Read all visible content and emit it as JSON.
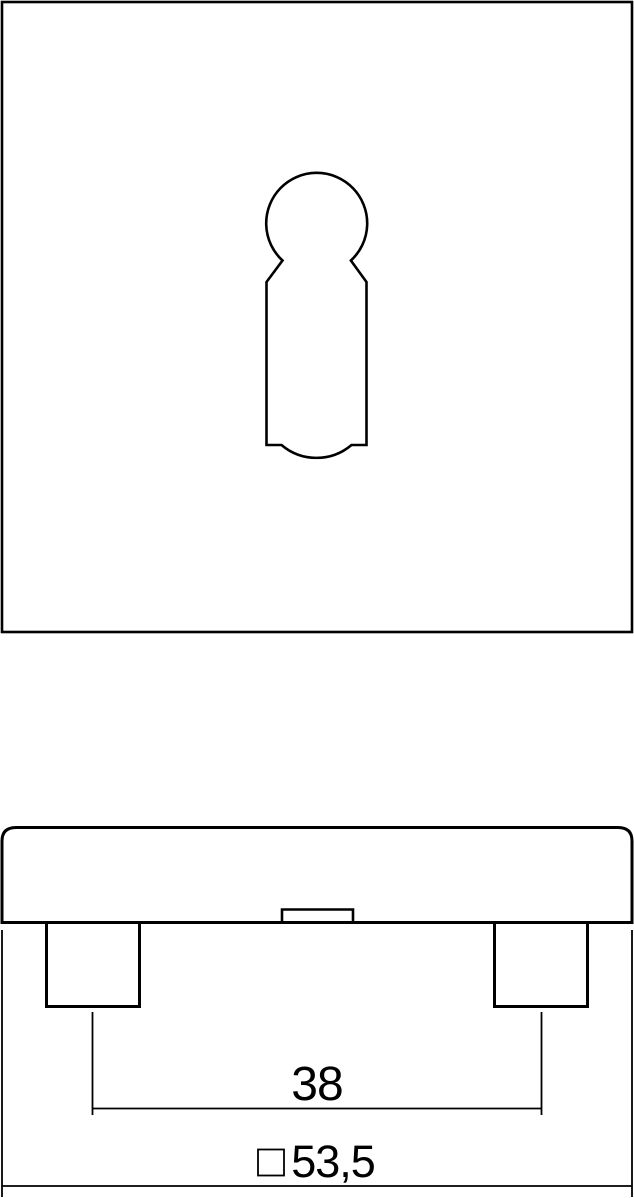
{
  "colors": {
    "line": "#000000",
    "background": "#ffffff"
  },
  "dimensions": {
    "post_spacing": {
      "value": "38"
    },
    "plate_size": {
      "symbol": "□",
      "value": "53,5"
    }
  }
}
